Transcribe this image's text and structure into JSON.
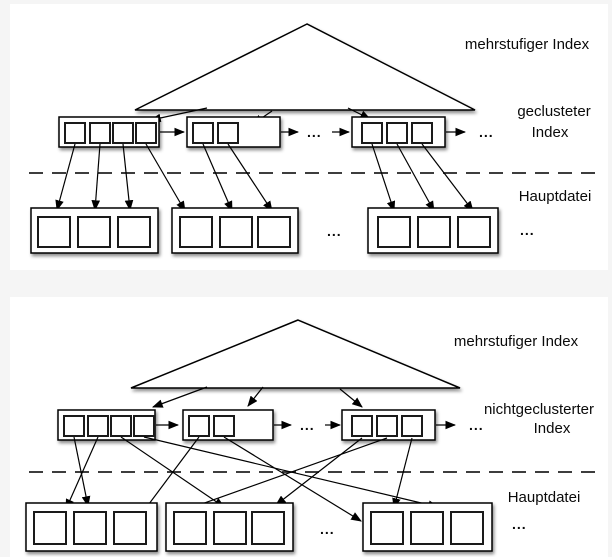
{
  "colors": {
    "background": "#f5f5f5",
    "panel": "#ffffff",
    "ink": "#000000"
  },
  "diagram1": {
    "title_label": "mehrstufiger Index",
    "index_label_line1": "geclusteter",
    "index_label_line2": "Index",
    "file_label": "Hauptdatei",
    "ellipsis": "...",
    "structure": {
      "index_block_entries": [
        4,
        2,
        3
      ],
      "data_block_entries": [
        3,
        3,
        3
      ]
    }
  },
  "diagram2": {
    "title_label": "mehrstufiger Index",
    "index_label_line1": "nichtgeclusterter",
    "index_label_line2": "Index",
    "file_label": "Hauptdatei",
    "ellipsis": "...",
    "structure": {
      "index_block_entries": [
        4,
        2,
        3
      ],
      "data_block_entries": [
        3,
        3,
        3
      ]
    }
  }
}
